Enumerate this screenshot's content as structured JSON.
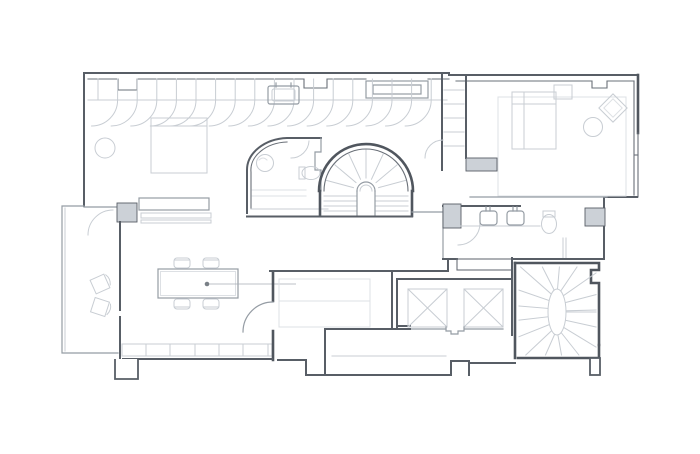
{
  "meta": {
    "title": "apartment-floor-plan",
    "drawing_type": "architectural-plan",
    "background": "#ffffff"
  },
  "palette": {
    "wall_dark": "#50565e",
    "wall": "#585e66",
    "wall_medium": "#959ca4",
    "furniture_light": "#c8cdd3",
    "furniture_faint": "#dde0e4",
    "pier_fill": "#ccd1d7"
  },
  "rooms": {
    "master_bedroom": {
      "label": "master bedroom",
      "fixtures": [
        "wardrobe-scallops",
        "double-bed",
        "round-stool",
        "sideboard",
        "door-swing"
      ]
    },
    "central_bathroom": {
      "label": "curved bathroom",
      "fixtures": [
        "round-basin",
        "toilet",
        "shower-lines",
        "door-swing"
      ]
    },
    "main_staircase": {
      "label": "fan staircase",
      "fixtures": [
        "radial-treads",
        "straight-treads",
        "arched-newel"
      ]
    },
    "closet_shaft": {
      "label": "closet shaft",
      "fixtures": [
        "shelves",
        "door-swing"
      ]
    },
    "right_bedroom": {
      "label": "right bedroom",
      "fixtures": [
        "bed",
        "nightstand",
        "rotated-armchair",
        "round-table",
        "rug"
      ]
    },
    "right_bathroom": {
      "label": "bathroom strip",
      "fixtures": [
        "basin",
        "basin",
        "toilet",
        "door-swing"
      ]
    },
    "elevators": {
      "label": "elevator shafts",
      "count": 2,
      "fixtures": [
        "lift-x-symbol",
        "lift-x-symbol"
      ]
    },
    "winder_staircase": {
      "label": "oval winder staircase",
      "fixtures": [
        "oval-newel",
        "radial-treads"
      ]
    },
    "dining_room": {
      "label": "dining room",
      "fixtures": [
        "dining-table",
        "chair",
        "chair",
        "chair",
        "chair",
        "pendant-light",
        "window-mullions"
      ]
    },
    "living_room": {
      "label": "living room",
      "fixtures": [
        "daybed-sofa",
        "door-swing"
      ]
    },
    "balcony": {
      "label": "balcony",
      "fixtures": [
        "rotated-chair",
        "rotated-chair"
      ]
    },
    "corridor": {
      "label": "corridor",
      "fixtures": []
    }
  }
}
